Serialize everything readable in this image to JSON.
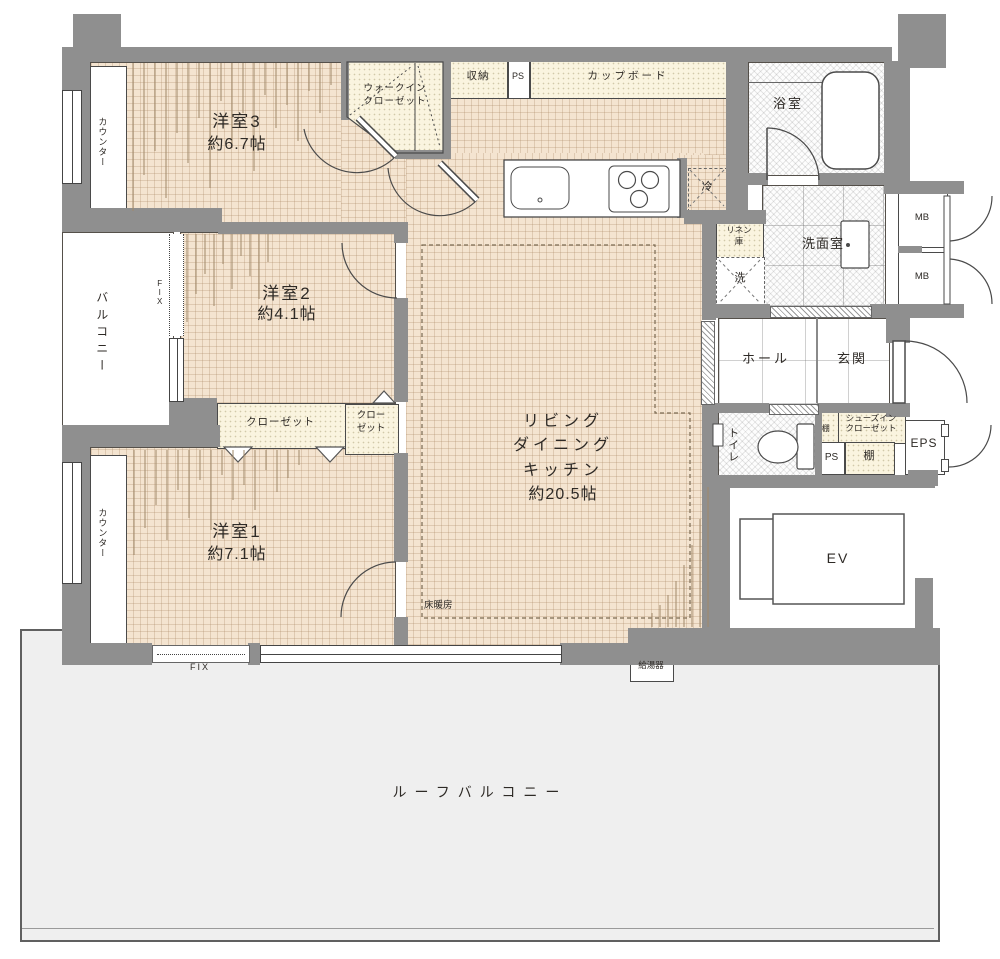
{
  "plan": {
    "bedroom3": {
      "name": "洋室3",
      "size": "約6.7帖"
    },
    "bedroom2": {
      "name": "洋室2",
      "size": "約4.1帖"
    },
    "bedroom1": {
      "name": "洋室1",
      "size": "約7.1帖"
    },
    "ldk": {
      "name_line1": "リビング",
      "name_line2": "ダイニング",
      "name_line3": "キッチン",
      "size": "約20.5帖"
    },
    "bathroom": {
      "name": "浴室"
    },
    "washroom": {
      "name": "洗面室"
    },
    "toilet": {
      "name": "トイレ"
    },
    "hall": {
      "name": "ホール"
    },
    "entrance": {
      "name": "玄関"
    },
    "balcony": {
      "name": "バルコニー",
      "fix_window": "FIX"
    },
    "roof_balcony": {
      "name": "ルーフバルコニー"
    },
    "wic": {
      "line1": "ウォークイン",
      "line2": "クローゼット"
    },
    "closet_wide": {
      "name": "クローゼット"
    },
    "closet_small": {
      "line1": "クロー",
      "line2": "ゼット"
    },
    "shoes_closet": {
      "line1": "シューズイン",
      "line2": "クローゼット"
    },
    "storage": {
      "name": "収納"
    },
    "cupboard": {
      "name": "カップボード"
    },
    "linen": {
      "line1": "リネン",
      "line2": "庫"
    },
    "counter_top": {
      "name": "カウンター"
    },
    "counter_bottom": {
      "name": "カウンター"
    },
    "shelf_vertical": {
      "name": "棚"
    },
    "shelf_lower": {
      "name": "棚"
    },
    "ps_top": {
      "name": "PS"
    },
    "ps_lower": {
      "name": "PS"
    },
    "mb_upper": {
      "name": "MB"
    },
    "mb_lower": {
      "name": "MB"
    },
    "eps": {
      "name": "EPS"
    },
    "ev": {
      "name": "EV"
    },
    "fridge": {
      "name": "冷"
    },
    "washer": {
      "name": "洗"
    },
    "floor_heating": {
      "name": "床暖房"
    },
    "water_heater": {
      "name": "給湯器"
    },
    "fix_window_bottom": {
      "name": "FIX"
    },
    "colors": {
      "wall": "#8f8f8f",
      "floor": "#f4e4d0",
      "storage_fill": "#faf4df",
      "roof_balcony_fill": "#efefef",
      "line": "#4a4a4a"
    }
  }
}
